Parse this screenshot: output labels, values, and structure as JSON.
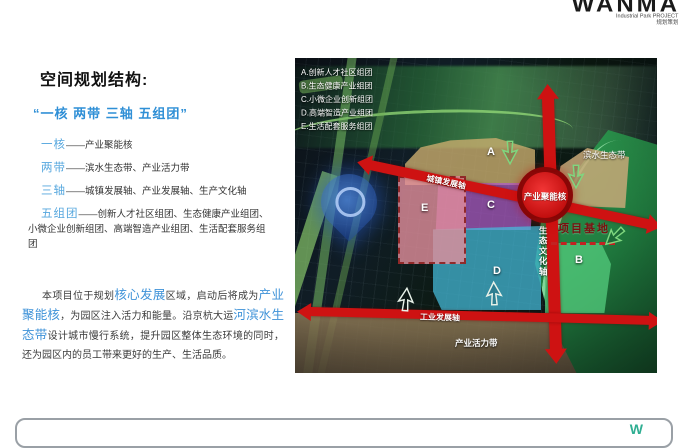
{
  "header": {
    "logo": "WANMA",
    "tagline_en": "Industrial Park    PROJECT",
    "tagline_cn": "规划策划"
  },
  "left": {
    "title": "空间规划结构:",
    "subtitle": "“一核 两带 三轴 五组团”",
    "items": [
      {
        "label": "一核",
        "text": "——产业聚能核"
      },
      {
        "label": "两带",
        "text": "——滨水生态带、产业活力带"
      },
      {
        "label": "三轴",
        "text": "——城镇发展轴、产业发展轴、生产文化轴"
      },
      {
        "label": "五组团",
        "text": "——创新人才社区组团、生态健康产业组团、小微企业创新组团、高端智造产业组团、生活配套服务组团"
      }
    ],
    "paragraph": {
      "part1": "本项目位于规划",
      "highlight1": "核心发展",
      "part2": "区域，启动后将成为",
      "highlight2": "产业聚能核",
      "part3": "，为园区注入活力和能量。沿京杭大运",
      "highlight3": "河滨水生态带",
      "part4": "设计城市慢行系统，提升园区整体生态环境的同时，还为园区内的员工带来更好的生产、生活品质。"
    }
  },
  "map": {
    "legend": [
      "A.创新人才社区组团",
      "B.生态健康产业组团",
      "C.小微企业创新组团",
      "D.高端智造产业组团",
      "E.生活配套服务组团"
    ],
    "zone_letters": [
      "A",
      "B",
      "C",
      "D",
      "E"
    ],
    "labels": {
      "core": "产业聚能核",
      "site": "项目基地",
      "axis_town": "城镇发展轴",
      "axis_eco": "生态文化轴",
      "axis_industry": "工业发展轴",
      "waterfront": "滨水生态带",
      "vitality": "产业活力带"
    },
    "colors": {
      "axis_red": "#CE1212",
      "zone_a": "#C9AD6E",
      "zone_b": "#52C97B",
      "zone_c": "#B05CC9",
      "zone_d": "#45BCDD",
      "zone_e": "#E28E9C",
      "site_label": "#7A1010",
      "highlight_blue": "#3E92D8"
    }
  },
  "footer": {
    "watermark": "W"
  }
}
